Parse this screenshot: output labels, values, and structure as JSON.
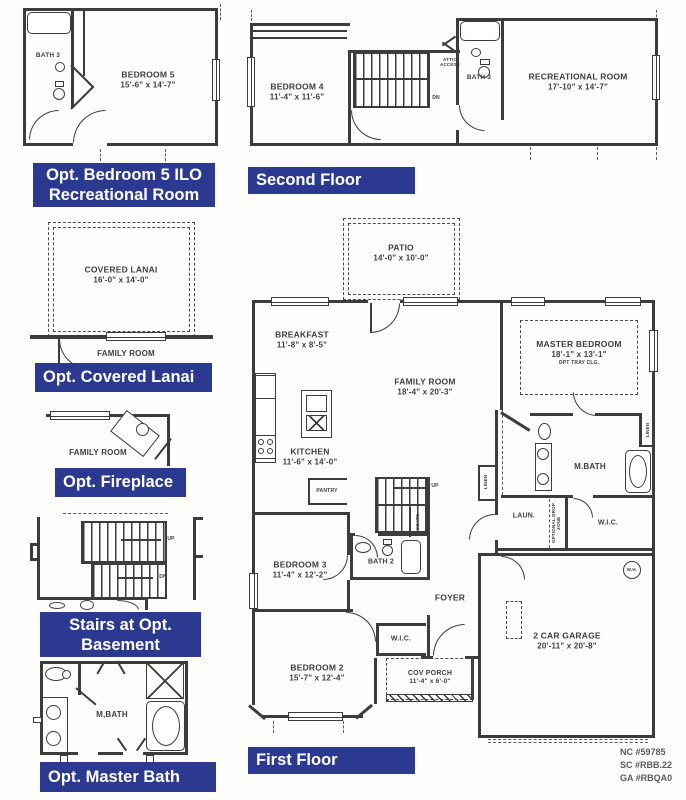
{
  "colors": {
    "badge_bg": "#2b3990",
    "wall": "#3c3c3c",
    "label_text": "#3f3f3f",
    "paper": "#fdfdfc",
    "footer_text": "#5a5a5a"
  },
  "plans": {
    "opt_bedroom5": {
      "badge_line1": "Opt. Bedroom 5 ILO",
      "badge_line2": "Recreational Room",
      "rooms": {
        "bath3": {
          "name": "BATH 3"
        },
        "bedroom5": {
          "name": "BEDROOM 5",
          "dims": "15'-6\" x 14'-7\""
        }
      }
    },
    "second_floor": {
      "badge": "Second Floor",
      "rooms": {
        "bedroom4": {
          "name": "BEDROOM 4",
          "dims": "11'-4\" x 11'-6\""
        },
        "attic_access": {
          "name": "ATTIC ACCESS"
        },
        "stairs_dn": {
          "name": "DN"
        },
        "bath3": {
          "name": "BATH 3"
        },
        "rec_room": {
          "name": "RECREATIONAL ROOM",
          "dims": "17'-10\" x 14'-7\""
        }
      }
    },
    "opt_covered_lanai": {
      "badge": "Opt. Covered Lanai",
      "rooms": {
        "lanai": {
          "name": "COVERED LANAI",
          "dims": "16'-0\" x 14'-0\""
        },
        "family_room": {
          "name": "FAMILY ROOM"
        }
      }
    },
    "opt_fireplace": {
      "badge": "Opt. Fireplace",
      "rooms": {
        "family_room": {
          "name": "FAMILY ROOM"
        }
      }
    },
    "stairs_opt_basement": {
      "badge_line1": "Stairs at Opt.",
      "badge_line2": "Basement",
      "rooms": {
        "up": {
          "name": "UP"
        },
        "dn": {
          "name": "DN"
        }
      }
    },
    "opt_master_bath": {
      "badge": "Opt. Master Bath",
      "rooms": {
        "mbath": {
          "name": "M,BATH"
        }
      }
    },
    "first_floor": {
      "badge": "First Floor",
      "rooms": {
        "patio": {
          "name": "PATIO",
          "dims": "14'-0\" x 10'-0\""
        },
        "breakfast": {
          "name": "BREAKFAST",
          "dims": "11'-8\" x 8'-5\""
        },
        "kitchen": {
          "name": "KITCHEN",
          "dims": "11'-6\" x 14'-0\""
        },
        "pantry": {
          "name": "PANTRY"
        },
        "family_room": {
          "name": "FAMILY ROOM",
          "dims": "18'-4\" x 20'-3\""
        },
        "master_bedroom": {
          "name": "MASTER BEDROOM",
          "dims": "18'-1\" x 13'-1\"",
          "note": "OPT TRAY CLG."
        },
        "mbath": {
          "name": "M.BATH"
        },
        "linen1": {
          "name": "LINEN"
        },
        "linen2": {
          "name": "LINEN"
        },
        "wic_master": {
          "name": "W.I.C."
        },
        "laundry": {
          "name": "LAUN."
        },
        "drop_zone": {
          "name": "OPTIONAL DROP ZONE"
        },
        "stairs_up": {
          "name": "UP"
        },
        "coats": {
          "name": "COATS"
        },
        "bedroom3": {
          "name": "BEDROOM 3",
          "dims": "11'-4\" x 12'-2\""
        },
        "bath2": {
          "name": "BATH 2"
        },
        "foyer": {
          "name": "FOYER"
        },
        "wic_bed2": {
          "name": "W.I.C."
        },
        "bedroom2": {
          "name": "BEDROOM 2",
          "dims": "15'-7\" x 12'-4\""
        },
        "cov_porch": {
          "name": "COV PORCH",
          "dims": "11'-4\" x 6'-0\""
        },
        "garage": {
          "name": "2 CAR GARAGE",
          "dims": "20'-11\" x 20'-8\""
        },
        "water_heater": {
          "name": "W.H."
        }
      }
    }
  },
  "footer": {
    "line1": "NC #59785",
    "line2": "SC #RBB.22",
    "line3": "GA #RBQA0"
  }
}
